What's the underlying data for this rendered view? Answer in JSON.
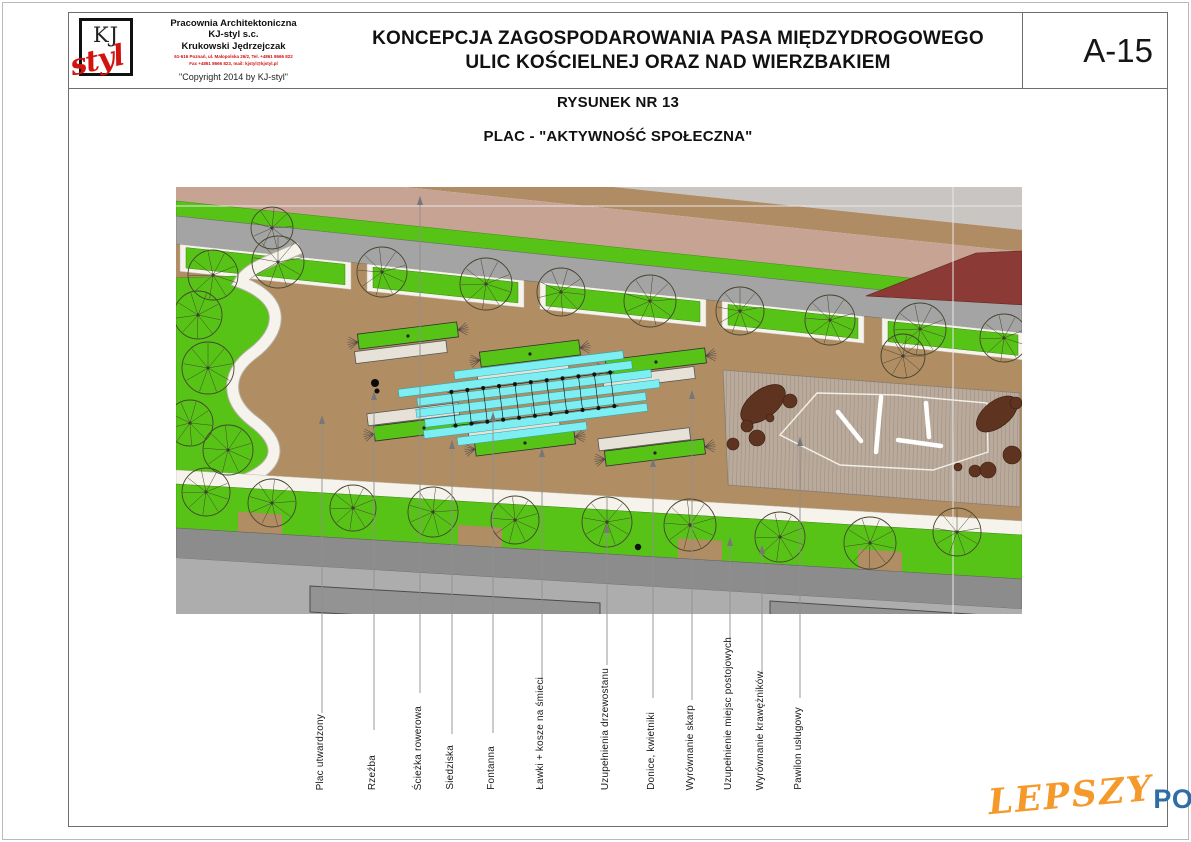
{
  "header": {
    "logo_kj": "KJ",
    "logo_styl": "styl",
    "firm_line1": "Pracownia Architektoniczna",
    "firm_line2": "KJ-styl s.c.",
    "firm_line3": "Krukowski Jędrzejczak",
    "address_line1": "61-616 Poznań, ul. Małopolska 26/2, Tel. +4861 8666 822",
    "address_line2": "Fax +4861 8666 823, mail: kjstyl@kjstyl.pl",
    "copyright": "\"Copyright 2014 by KJ-styl\"",
    "title_line1": "KONCEPCJA ZAGOSPODAROWANIA PASA MIĘDZYDROGOWEGO",
    "title_line2": "ULIC KOŚCIELNEJ ORAZ NAD WIERZBAKIEM",
    "sheet_number": "A-15"
  },
  "drawing": {
    "subtitle1": "RYSUNEK NR 13",
    "subtitle2": "PLAC - \"AKTYWNOŚĆ SPOŁECZNA\""
  },
  "watermark": {
    "part1": "LEPSZY",
    "part2": "POZNAN",
    "part3": ".pl"
  },
  "plan": {
    "colors": {
      "plaza": "#b08d63",
      "tan": "#b08c64",
      "pink": "#c7a394",
      "lightgray": "#c9c5c2",
      "darkred": "#8c3a36",
      "road": "#a4a4a4",
      "green": "#57c316",
      "path_white": "#f6f3ec",
      "deck": "#b9aa9c",
      "deck_hatch": "#8d7f72",
      "shrub": "#5e3420",
      "sidewalk_dark": "#8c8c8c",
      "road_light": "#adadad",
      "building": "#939393",
      "tree_line": "#45452f",
      "leader": "#8f8f8f",
      "fountain": "#7deef2",
      "fountain_edge": "#2aa0a8"
    },
    "labels": [
      {
        "text": "Plac utwardzony",
        "x": 322,
        "anchor_y": 415,
        "end_y": 713
      },
      {
        "text": "Rzeźba",
        "x": 374,
        "anchor_y": 391,
        "end_y": 730
      },
      {
        "text": "Ścieżka rowerowa",
        "x": 420,
        "anchor_y": 196,
        "end_y": 693
      },
      {
        "text": "Siedziska",
        "x": 452,
        "anchor_y": 440,
        "end_y": 734
      },
      {
        "text": "Fontanna",
        "x": 493,
        "anchor_y": 412,
        "end_y": 733
      },
      {
        "text": "Ławki + kosze na śmieci",
        "x": 542,
        "anchor_y": 448,
        "end_y": 680
      },
      {
        "text": "Uzupełnienia drzewostanu",
        "x": 607,
        "anchor_y": 524,
        "end_y": 665
      },
      {
        "text": "Donice, kwietniki",
        "x": 653,
        "anchor_y": 458,
        "end_y": 698
      },
      {
        "text": "Wyrównanie skarp",
        "x": 692,
        "anchor_y": 390,
        "end_y": 700
      },
      {
        "text": "Uzupełnienie miejsc postojowych",
        "x": 730,
        "anchor_y": 537,
        "end_y": 645
      },
      {
        "text": "Wyrównanie krawężników",
        "x": 762,
        "anchor_y": 545,
        "end_y": 673
      },
      {
        "text": "Pawilon usługowy",
        "x": 800,
        "anchor_y": 437,
        "end_y": 698
      }
    ],
    "trees": [
      [
        278,
        262,
        26
      ],
      [
        382,
        272,
        25
      ],
      [
        486,
        284,
        26
      ],
      [
        561,
        292,
        24
      ],
      [
        650,
        301,
        26
      ],
      [
        740,
        311,
        24
      ],
      [
        830,
        320,
        25
      ],
      [
        920,
        329,
        26
      ],
      [
        1004,
        338,
        24
      ],
      [
        213,
        275,
        25
      ],
      [
        272,
        228,
        21
      ],
      [
        198,
        315,
        24
      ],
      [
        208,
        368,
        26
      ],
      [
        190,
        423,
        23
      ],
      [
        228,
        450,
        25
      ],
      [
        206,
        492,
        24
      ],
      [
        272,
        503,
        24
      ],
      [
        353,
        508,
        23
      ],
      [
        433,
        512,
        25
      ],
      [
        515,
        520,
        24
      ],
      [
        607,
        522,
        25
      ],
      [
        690,
        525,
        26
      ],
      [
        780,
        537,
        25
      ],
      [
        870,
        543,
        26
      ],
      [
        957,
        532,
        24
      ],
      [
        903,
        356,
        22
      ]
    ],
    "planters": [
      {
        "x": 408,
        "y": 336,
        "t": "u"
      },
      {
        "x": 530,
        "y": 354,
        "t": "u"
      },
      {
        "x": 656,
        "y": 362,
        "t": "u"
      },
      {
        "x": 424,
        "y": 428,
        "t": "l"
      },
      {
        "x": 525,
        "y": 443,
        "t": "l"
      },
      {
        "x": 655,
        "y": 453,
        "t": "l"
      }
    ],
    "fountain": {
      "cx": 533,
      "cy": 400,
      "rot": -7,
      "bars": [
        [
          -34,
          10,
          170
        ],
        [
          -23,
          -15,
          235
        ],
        [
          -12,
          -40,
          150
        ],
        [
          -12,
          68,
          105
        ],
        [
          -1,
          5,
          245
        ],
        [
          10,
          -30,
          160
        ],
        [
          10,
          55,
          115
        ],
        [
          21,
          0,
          225
        ],
        [
          32,
          -15,
          130
        ]
      ]
    },
    "sculpture": {
      "x": 375,
      "y": 383
    },
    "person": {
      "x": 638,
      "y": 547
    },
    "deck": {
      "poly": [
        [
          723,
          370
        ],
        [
          1020,
          393
        ],
        [
          1020,
          507
        ],
        [
          728,
          485
        ]
      ],
      "outline": "780,435 817,393 897,395 987,403 988,452 933,470 840,465",
      "marks": [
        [
          838,
          412,
          861,
          441
        ],
        [
          881,
          397,
          876,
          452
        ],
        [
          926,
          403,
          929,
          437
        ],
        [
          898,
          440,
          941,
          446
        ]
      ]
    },
    "shrub_ellipses": [
      [
        763,
        404,
        26,
        14,
        -38
      ],
      [
        997,
        414,
        24,
        13,
        -38
      ]
    ],
    "shrub_dots": [
      [
        790,
        401,
        7
      ],
      [
        747,
        426,
        6
      ],
      [
        757,
        438,
        8
      ],
      [
        733,
        444,
        6
      ],
      [
        770,
        418,
        4
      ],
      [
        1016,
        403,
        6
      ],
      [
        975,
        471,
        6
      ],
      [
        988,
        470,
        8
      ],
      [
        1012,
        455,
        9
      ],
      [
        958,
        467,
        4
      ]
    ],
    "verge_chunks": [
      [
        186,
        345
      ],
      [
        373,
        518
      ],
      [
        546,
        700
      ],
      [
        728,
        858
      ],
      [
        888,
        1018
      ]
    ],
    "notches": [
      260,
      480,
      700,
      880
    ],
    "buildings": [
      [
        310,
        586,
        600,
        603
      ],
      [
        770,
        601,
        1000,
        616
      ]
    ]
  }
}
